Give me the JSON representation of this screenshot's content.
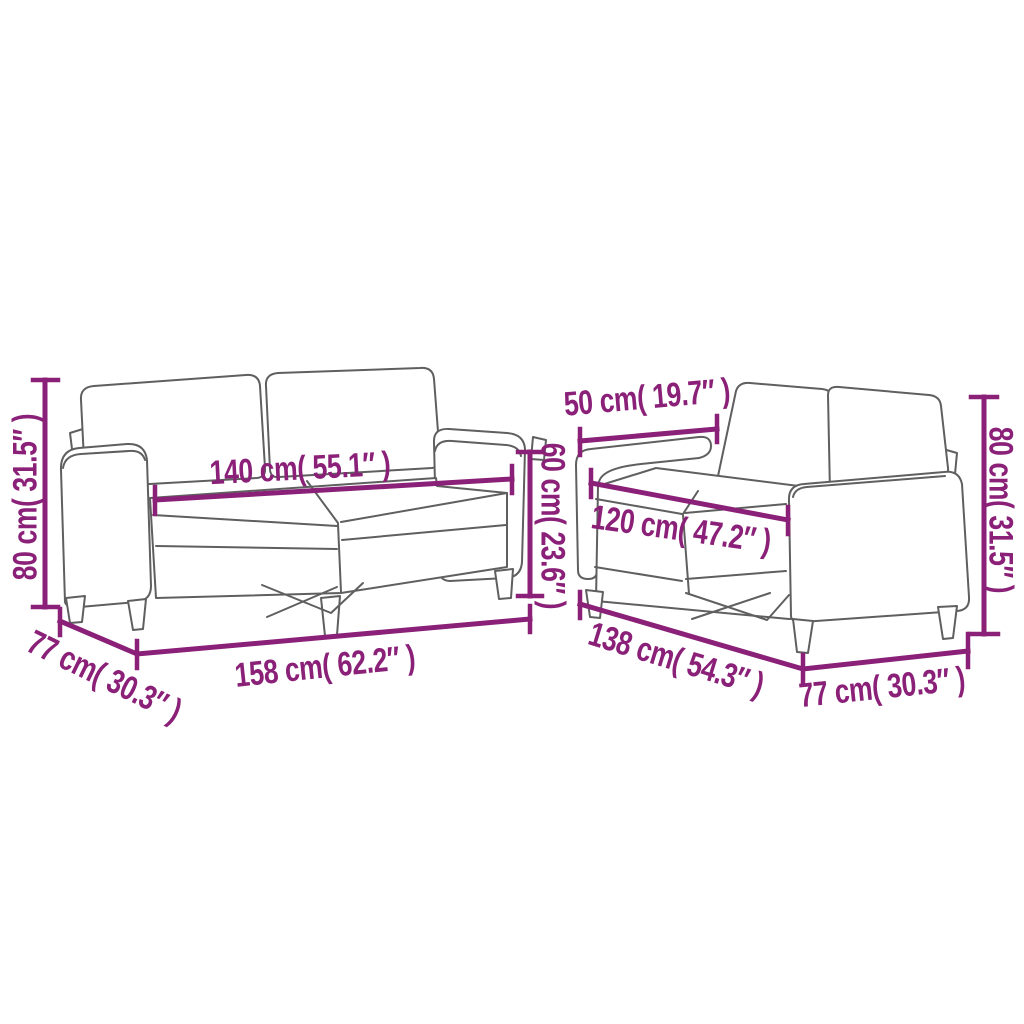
{
  "colors": {
    "accent": "#8a2077",
    "line": "#5f5f5f",
    "background": "#ffffff"
  },
  "annotations": {
    "left_sofa": {
      "height": "80 cm( 31.5″ )",
      "seat_width": "140 cm( 55.1″ )",
      "seat_height": "60 cm( 23.6″ )",
      "depth": "77 cm( 30.3″ )",
      "width": "158 cm( 62.2″ )"
    },
    "right_sofa": {
      "backrest_width": "50 cm( 19.7″ )",
      "seat_width": "120 cm( 47.2″ )",
      "height": "80 cm( 31.5″ )",
      "width": "138 cm( 54.3″ )",
      "depth": "77 cm( 30.3″ )"
    }
  }
}
